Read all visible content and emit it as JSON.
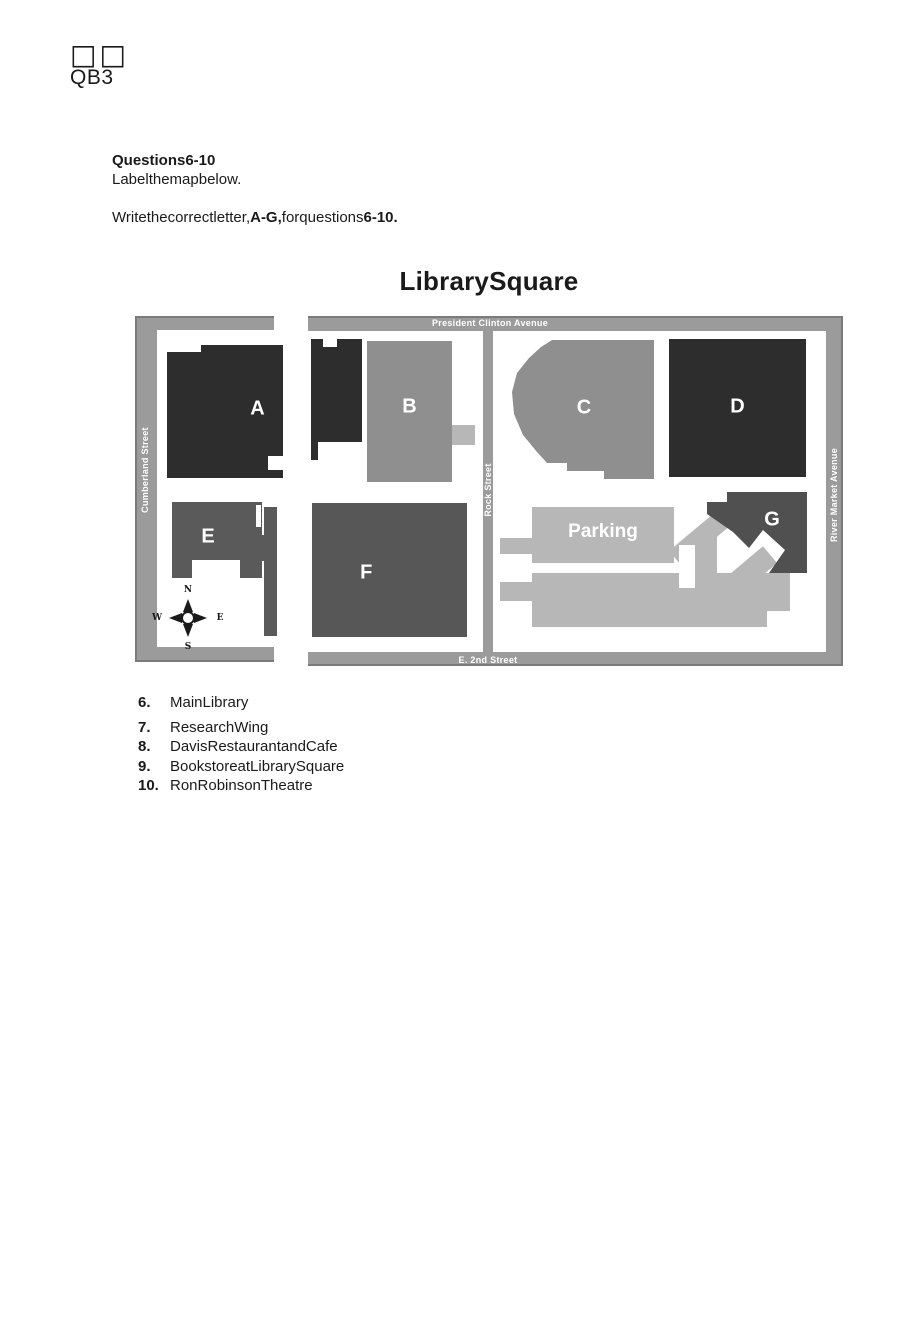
{
  "header": {
    "glyph_boxes": "□□",
    "code": "QB3"
  },
  "instructions": {
    "heading": "Questions6-10",
    "line1": "Labelthemapbelow.",
    "write_pre": "Writethecorrectletter,",
    "write_bold1": "A-G,",
    "write_mid": "forquestions",
    "write_bold2": "6-10."
  },
  "map": {
    "title": "LibrarySquare",
    "streets": {
      "top": "President Clinton Avenue",
      "left": "Cumberland Street",
      "middle": "Rock Street",
      "right": "River Market Avenue",
      "bottom": "E. 2nd Street"
    },
    "buildings": [
      {
        "label": "A"
      },
      {
        "label": "B"
      },
      {
        "label": "C"
      },
      {
        "label": "D"
      },
      {
        "label": "E"
      },
      {
        "label": "F"
      },
      {
        "label": "G"
      }
    ],
    "parking_label": "Parking",
    "compass": {
      "n": "N",
      "e": "E",
      "s": "S",
      "w": "W"
    },
    "colors": {
      "street_band": "#9b9b9b",
      "street_edge": "#7b7b7b",
      "dark_building": "#2d2d2d",
      "mid_building": "#8f8f8f",
      "medium_building": "#5a5a5a",
      "parking_area": "#b7b7b7",
      "label_text": "#ffffff"
    }
  },
  "questions": [
    {
      "number": "6.",
      "text": "MainLibrary"
    },
    {
      "number": "7.",
      "text": "ResearchWing"
    },
    {
      "number": "8.",
      "text": "DavisRestaurantandCafe"
    },
    {
      "number": "9.",
      "text": "BookstoreatLibrarySquare"
    },
    {
      "number": "10.",
      "text": "RonRobinsonTheatre"
    }
  ]
}
